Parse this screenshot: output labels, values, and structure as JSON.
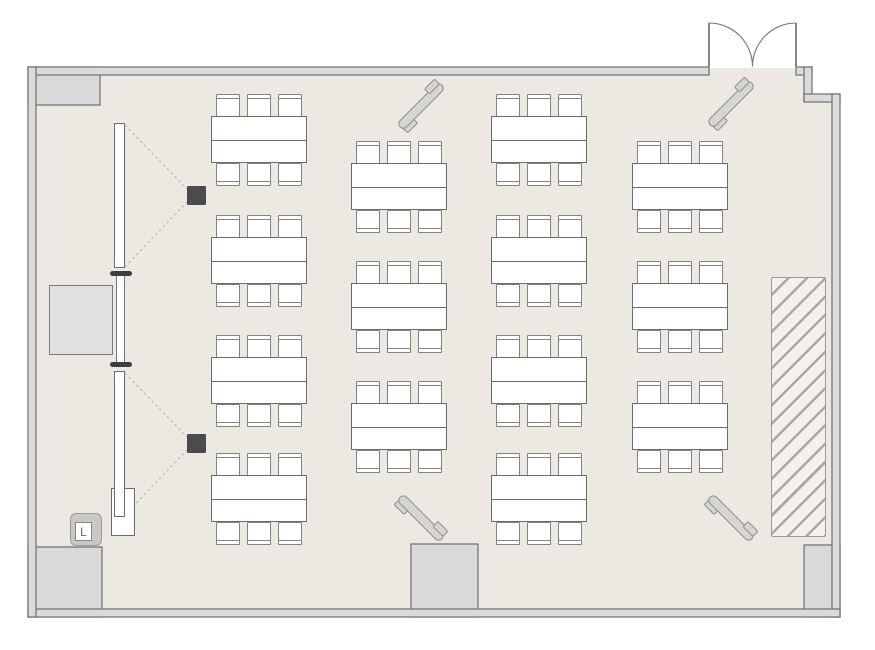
{
  "meta": {
    "type": "floor-plan",
    "description": "Top-down seminar room floor plan with rows of tables, wall screens, projectors, corner speakers and a double entrance door"
  },
  "palette": {
    "background": "#ffffff",
    "floor": "#ece9e2",
    "wall_fill": "#dbdbdc",
    "wall_stroke": "#6f6e6b",
    "furniture_fill": "#ffffff",
    "furniture_stroke": "#6e6c68",
    "chair_stroke": "#84827e",
    "block_fill": "#d9d9da",
    "projector_fill": "#4b4b4d",
    "screen_cap_fill": "#3e3e40",
    "speaker_fill": "#d6d5d2",
    "dotted_line": "#bab7ae",
    "hatch_line": "#a9a8a4",
    "switch_label_color": "#6b6965"
  },
  "floorplan": {
    "switch_label": "L",
    "totals": {
      "table_groups": 14,
      "seats": 84,
      "screens": 2,
      "projectors": 2,
      "speakers": 4,
      "doors": 1
    },
    "table_groups": {
      "group_width": 96,
      "group_height": 92,
      "chairs_per_group": 6,
      "columns": [
        {
          "x": 211,
          "rows": [
            94,
            215,
            335,
            453
          ]
        },
        {
          "x": 351,
          "rows": [
            141,
            261,
            381
          ]
        },
        {
          "x": 491,
          "rows": [
            94,
            215,
            335,
            453
          ]
        },
        {
          "x": 632,
          "rows": [
            141,
            261,
            381
          ]
        }
      ]
    },
    "speakers": [
      {
        "cx": 421,
        "cy": 106,
        "dir": "ne"
      },
      {
        "cx": 731,
        "cy": 104,
        "dir": "ne"
      },
      {
        "cx": 421,
        "cy": 518,
        "dir": "se"
      },
      {
        "cx": 731,
        "cy": 518,
        "dir": "se"
      }
    ]
  }
}
